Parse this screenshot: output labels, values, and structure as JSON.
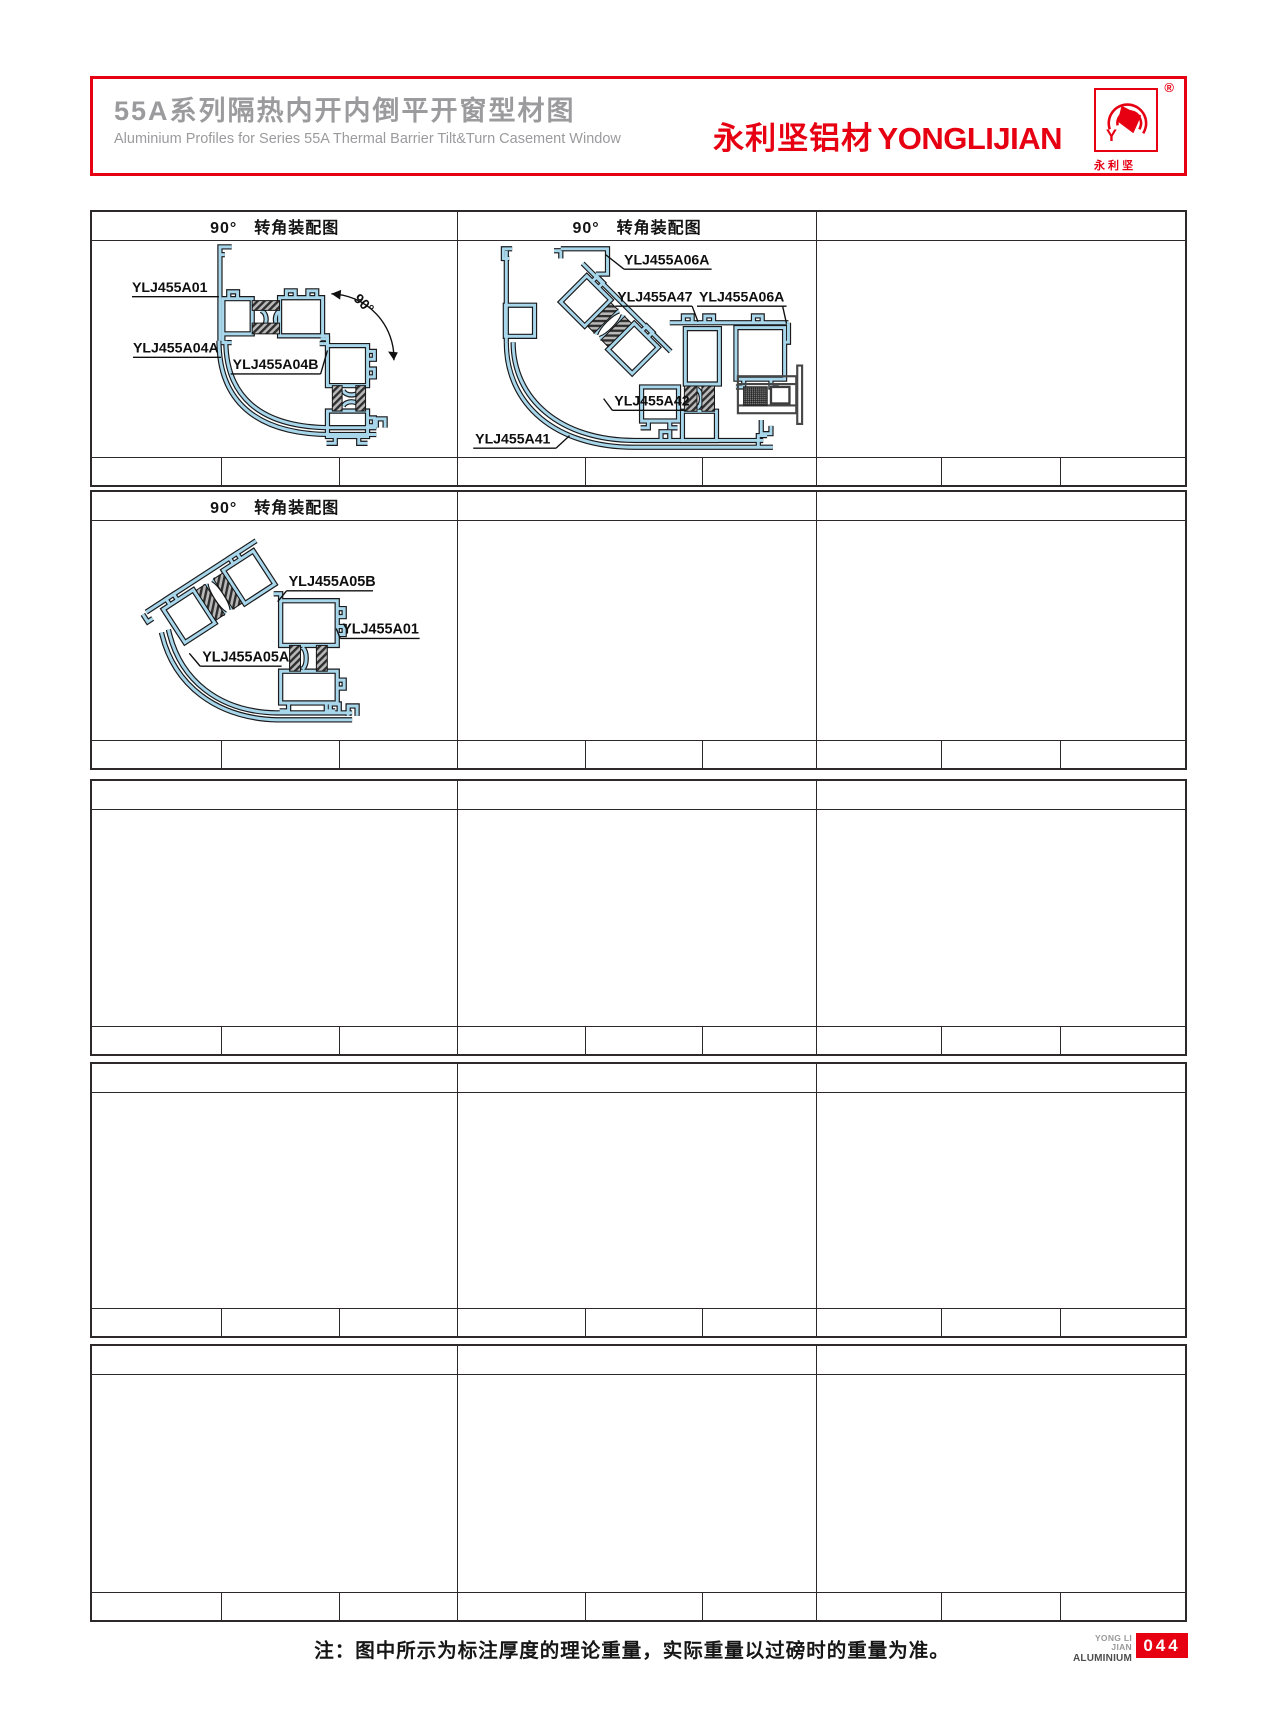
{
  "header": {
    "title_cn": "55A系列隔热内开内倒平开窗型材图",
    "title_en": "Aluminium Profiles for Series 55A Thermal Barrier Tilt&Turn Casement Window",
    "brand_cn": "永利坚铝材",
    "brand_en": "YONGLIJIAN",
    "logo": {
      "registered": "®",
      "monogram": "Y",
      "caption": "永 利 坚"
    },
    "brand_color": "#e60012"
  },
  "blocks": [
    {
      "headers": [
        "90°　转角装配图",
        "90°　转角装配图",
        ""
      ]
    },
    {
      "headers": [
        "90°　转角装配图",
        "",
        ""
      ]
    },
    {
      "headers": [
        "",
        "",
        ""
      ]
    },
    {
      "headers": [
        "",
        "",
        ""
      ]
    },
    {
      "headers": [
        "",
        "",
        ""
      ]
    }
  ],
  "diagrams": [
    {
      "title": "90°　转角装配图",
      "angle": "90°",
      "labels": [
        "YLJ455A01",
        "YLJ455A04A",
        "YLJ455A04B"
      ]
    },
    {
      "title": "90°　转角装配图",
      "labels": [
        "YLJ455A06A",
        "YLJ455A47",
        "YLJ455A06A",
        "YLJ455A42",
        "YLJ455A41"
      ]
    },
    {
      "title": "90°　转角装配图",
      "labels": [
        "YLJ455A05B",
        "YLJ455A01",
        "YLJ455A05A"
      ]
    }
  ],
  "footer": {
    "note": "注：图中所示为标注厚度的理论重量，实际重量以过磅时的重量为准。",
    "mark_line1": "YONG LI JIAN",
    "mark_line2": "ALUMINIUM",
    "page_number": "044"
  },
  "colors": {
    "brand_red": "#e60012",
    "title_gray": "#9b9b9e",
    "profile_blue": "#a8d7eb",
    "line_black": "#1a1a1c",
    "table_border": "#2d292a"
  }
}
